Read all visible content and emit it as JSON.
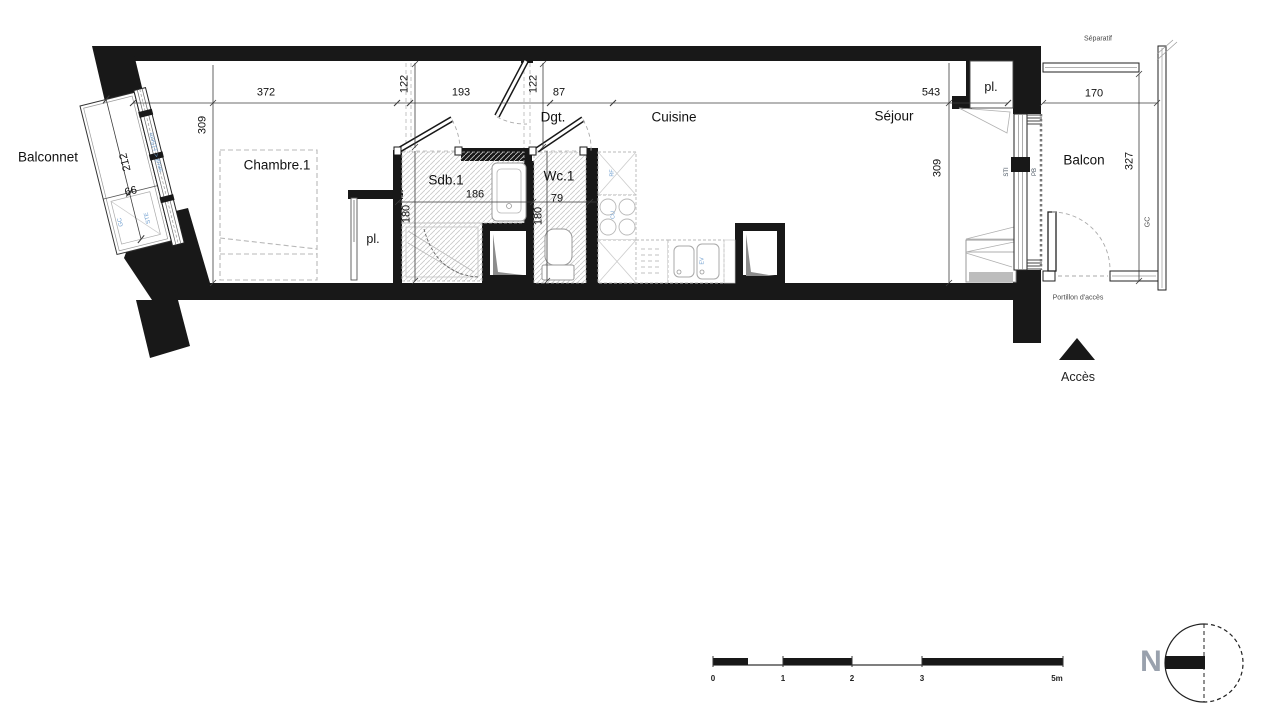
{
  "rooms": {
    "balconnet": "Balconnet",
    "chambre": "Chambre.1",
    "closet1": "pl.",
    "sdb": "Sdb.1",
    "wc": "Wc.1",
    "dgt": "Dgt.",
    "cuisine": "Cuisine",
    "sejour": "Séjour",
    "closet2": "pl.",
    "balcon": "Balcon"
  },
  "dims": {
    "top_372": "372",
    "top_122_left": "122",
    "top_193": "193",
    "top_122_right": "122",
    "top_87": "87",
    "top_543": "543",
    "left_309": "309",
    "right_309": "309",
    "sdb_186": "186",
    "sdb_180": "180",
    "wc_79": "79",
    "wc_180": "180",
    "balconnet_212": "212",
    "balconnet_66": "66",
    "balcon_170": "170",
    "balcon_327": "327"
  },
  "annotations": {
    "seuil": "seuil < ±15cm",
    "gc_left": "GC",
    "ste": "STE",
    "sti": "STI",
    "pb": "PB",
    "separatif": "Séparatif",
    "gc_right": "GC",
    "portillon": "Portillon d'accès",
    "acces": "Accès",
    "rf": "RF",
    "cu": "CU",
    "ev": "EV"
  },
  "scalebar": {
    "t0": "0",
    "t1": "1",
    "t2": "2",
    "t3": "3",
    "t5": "5m"
  },
  "compass": {
    "north": "N"
  },
  "colors": {
    "wall": "#181818",
    "accent_blue": "#6f9ecf",
    "hatch": "#c8c8c8"
  }
}
